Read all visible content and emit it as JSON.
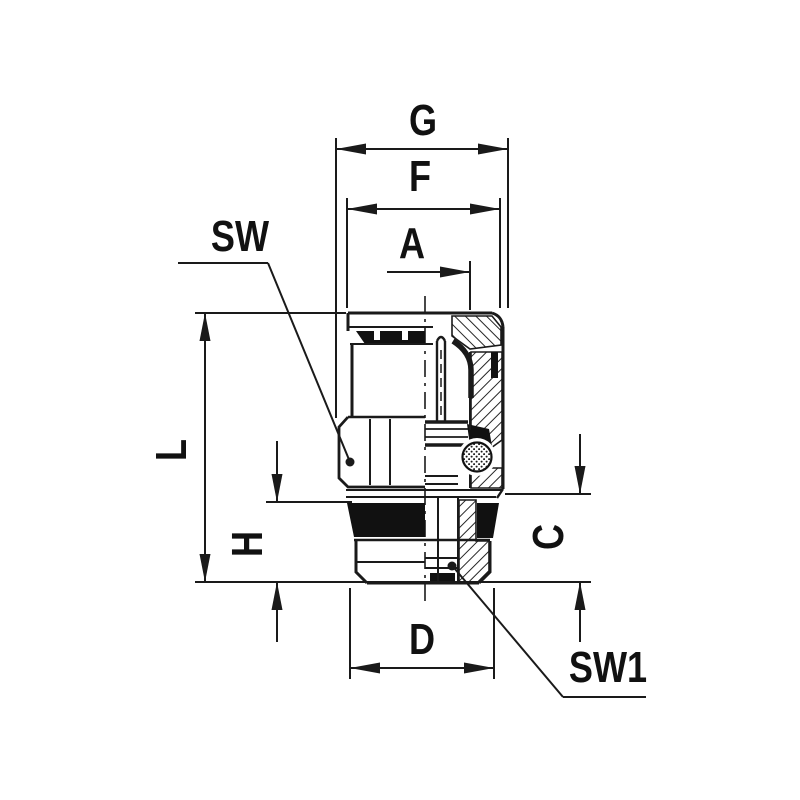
{
  "drawing": {
    "type": "dimensioned cross-section technical drawing of a push-in pneumatic fitting (male straight connector)",
    "colors": {
      "line": "#1a1a1a",
      "background": "#ffffff",
      "fill_black": "#111111"
    },
    "labels": {
      "G": "G",
      "F": "F",
      "A": "A",
      "SW": "SW",
      "L": "L",
      "H": "H",
      "C": "C",
      "D": "D",
      "SW1": "SW1"
    },
    "dimensions": [
      {
        "id": "G",
        "orientation": "horizontal",
        "measures": "overall cap width"
      },
      {
        "id": "F",
        "orientation": "horizontal",
        "measures": "body width"
      },
      {
        "id": "A",
        "orientation": "horizontal",
        "measures": "offset from centerline"
      },
      {
        "id": "L",
        "orientation": "vertical",
        "measures": "overall body height"
      },
      {
        "id": "H",
        "orientation": "vertical",
        "measures": "seal plus thread height"
      },
      {
        "id": "C",
        "orientation": "vertical",
        "measures": "thread section height"
      },
      {
        "id": "D",
        "orientation": "horizontal",
        "measures": "thread diameter"
      },
      {
        "id": "SW",
        "orientation": "leader",
        "measures": "hex wrench size, body"
      },
      {
        "id": "SW1",
        "orientation": "leader",
        "measures": "hex wrench size, thread end"
      }
    ]
  }
}
